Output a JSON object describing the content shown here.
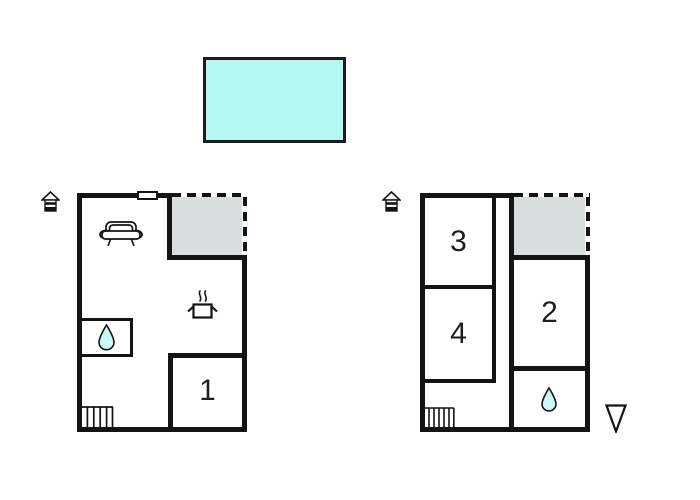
{
  "colors": {
    "wall": "#141414",
    "pool_fill": "#b5f7f3",
    "terrace_fill": "#d8dedd",
    "water_drop_fill": "#cdf6f6",
    "background": "#ffffff"
  },
  "floors": {
    "left": {
      "rooms": {
        "room1": "1"
      },
      "icons": [
        "house-icon",
        "window",
        "terrace",
        "sofa-icon",
        "stove-pot-icon",
        "water-drop-icon",
        "stairs-icon"
      ]
    },
    "right": {
      "rooms": {
        "room2": "2",
        "room3": "3",
        "room4": "4"
      },
      "icons": [
        "house-icon",
        "terrace",
        "water-drop-icon",
        "stairs-icon",
        "direction-triangle-icon"
      ]
    }
  }
}
